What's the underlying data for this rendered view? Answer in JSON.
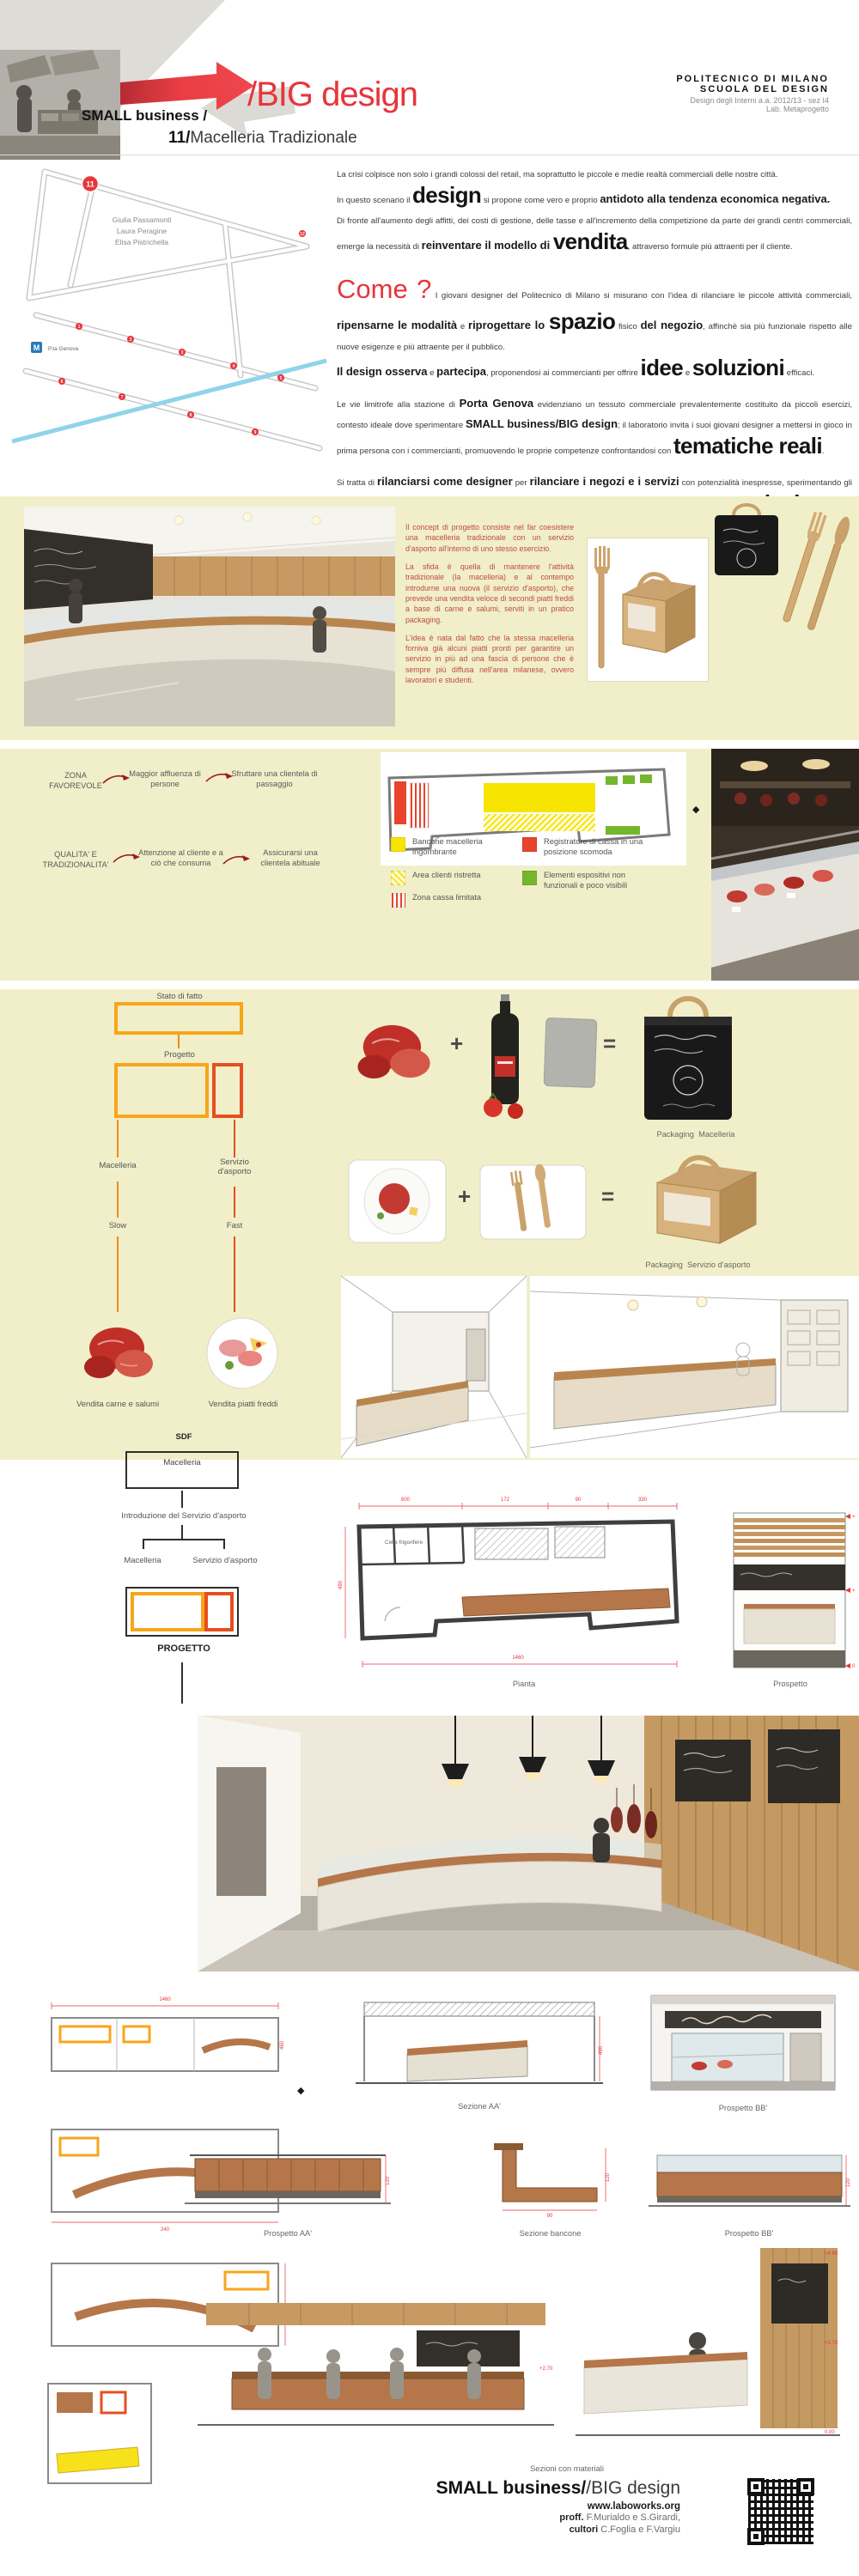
{
  "colors": {
    "accent_red": "#e8353b",
    "band_yellow": "#f1efc9",
    "orange": "#f9a51a",
    "red_orange": "#e54f20",
    "legend_yellow": "#f7e400",
    "legend_red": "#e8432c",
    "legend_green": "#74b62c",
    "concept_red": "#bf4a3c",
    "flow_arrow": "#9b1d1f"
  },
  "header": {
    "brand_small": "SMALL business /",
    "brand_big": "/BIG design",
    "project_number": "11/",
    "project_title": "Macelleria Tradizionale",
    "school_line1": "POLITECNICO DI MILANO",
    "school_line2": "SCUOLA DEL DESIGN",
    "course_line1": "Design degli Interni a.a. 2012/13 -  sez I4",
    "course_line2": "Lab. Metaprogetto"
  },
  "map": {
    "authors": [
      "Giulia Passamonti",
      "Laura Peragine",
      "Elisa Pistrichella"
    ],
    "highlight_marker": "11",
    "markers": [
      "1",
      "2",
      "3",
      "4",
      "5",
      "6",
      "7",
      "8",
      "9",
      "12"
    ],
    "metro": "M",
    "station": "P.ta Genova"
  },
  "intro": {
    "p1": [
      {
        "s": "r",
        "t": "La crisi colpisce non solo i grandi colossi del retail, ma soprattutto le piccole e medie realtà commerciali delle nostre città.\nIn questo scenario il "
      },
      {
        "s": "x",
        "t": "design"
      },
      {
        "s": "r",
        "t": " si propone come vero e proprio "
      },
      {
        "s": "b",
        "t": "antidoto alla tendenza economica negativa."
      },
      {
        "s": "r",
        "t": "\nDi fronte all'aumento degli affitti, dei costi di gestione, delle tasse e all'incremento della competizione da parte dei grandi centri commerciali, emerge la necessità di "
      },
      {
        "s": "b",
        "t": "reinventare il modello di "
      },
      {
        "s": "x",
        "t": "vendita"
      },
      {
        "s": "r",
        "t": ", attraverso formule più attraenti per il cliente."
      }
    ],
    "p2": [
      {
        "s": "c",
        "t": "Come ?"
      },
      {
        "s": "r",
        "t": " I giovani designer del Politecnico di Milano si misurano con l'idea di rilanciare le piccole attività commerciali, "
      },
      {
        "s": "b",
        "t": "ripensarne le modalità"
      },
      {
        "s": "r",
        "t": " e "
      },
      {
        "s": "b",
        "t": "riprogettare lo "
      },
      {
        "s": "x",
        "t": "spazio"
      },
      {
        "s": "r",
        "t": " fisico "
      },
      {
        "s": "b",
        "t": "del negozio"
      },
      {
        "s": "r",
        "t": ", affinchè sia più funzionale rispetto alle nuove esigenze e più attraente per il pubblico.\n"
      },
      {
        "s": "b",
        "t": "Il design osserva"
      },
      {
        "s": "r",
        "t": " e "
      },
      {
        "s": "b",
        "t": "partecipa"
      },
      {
        "s": "r",
        "t": ", proponendosi ai commercianti per offrire "
      },
      {
        "s": "x",
        "t": "idee"
      },
      {
        "s": "r",
        "t": " e "
      },
      {
        "s": "x",
        "t": "soluzioni"
      },
      {
        "s": "r",
        "t": " efficaci."
      }
    ],
    "p3": [
      {
        "s": "r",
        "t": "Le vie limitrofe alla stazione di "
      },
      {
        "s": "b",
        "t": "Porta Genova"
      },
      {
        "s": "r",
        "t": " evidenziano un tessuto commerciale prevalentemente costituito da piccoli esercizi, contesto ideale dove sperimentare "
      },
      {
        "s": "b",
        "t": "SMALL business/BIG design"
      },
      {
        "s": "r",
        "t": "; il laboratorio invita i suoi giovani designer a mettersi in gioco in prima persona con i commercianti, promuovendo le proprie competenze confrontandosi con "
      },
      {
        "s": "x",
        "t": "tematiche reali"
      },
      {
        "s": "r",
        "t": "."
      }
    ],
    "p4": [
      {
        "s": "r",
        "t": "Si tratta di "
      },
      {
        "s": "b",
        "t": "rilanciarsi come designer"
      },
      {
        "s": "r",
        "t": " per "
      },
      {
        "s": "b",
        "t": "rilanciare i negozi e i servizi"
      },
      {
        "s": "r",
        "t": " con potenzialità inespresse, sperimentando gli strumenti del progetto di interni; "
      },
      {
        "s": "b",
        "t": "promuovere le piccole realtà di vendita"
      },
      {
        "s": "r",
        "t": " che caratterizzano la "
      },
      {
        "s": "x",
        "t": "ricchezza"
      },
      {
        "s": "r",
        "t": " non solo commerciale ma anche sociale "
      },
      {
        "s": "b",
        "t": "di un quartiere."
      }
    ]
  },
  "concept": {
    "p1": "Il concept di progetto consiste nel far coesistere una macelleria tradizionale con un servizio d'asporto all'interno di uno stesso esercizio.",
    "p2": "La sfida è quella di mantenere l'attività tradizionale (la macelleria) e al contempo introdurne una nuova (il servizio d'asporto), che prevede una vendita veloce di secondi piatti freddi a base di carne e salumi, serviti in un pratico packaging.",
    "p3": "L'idea è nata dal fatto che la stessa macelleria forniva già alcuni piatti pronti per garantire un servizio in più ad una fascia di persone che è sempre più diffusa nell'area milanese, ovvero lavoratori e studenti."
  },
  "analysis": {
    "flow1": {
      "a": "ZONA FAVOREVOLE",
      "b": "Maggior affluenza di persone",
      "c": "Sfruttare una clientela di passaggio"
    },
    "flow2": {
      "a": "QUALITA' E TRADIZIONALITA'",
      "b": "Attenzione al cliente e a ciò che consuma",
      "c": "Assicurarsi una clientela abituale"
    },
    "legend": [
      {
        "label": "Bancone macelleria ingombrante"
      },
      {
        "label": "Registratore di cassa in una posizione scomoda"
      },
      {
        "label": "Area clienti ristretta"
      },
      {
        "label": "Zona cassa limitata"
      },
      {
        "label": "Elementi espositivi non funzionali e poco visibili"
      }
    ]
  },
  "strategy": {
    "state": "Stato di fatto",
    "project": "Progetto",
    "macelleria": "Macelleria",
    "servizio": "Servizio d'asporto",
    "slow": "Slow",
    "fast": "Fast",
    "caption_meat": "Vendita carne e salumi",
    "caption_plates": "Vendita piatti freddi",
    "plus": "+",
    "equals": "=",
    "packaging": "Packaging",
    "pack1": "Macelleria",
    "pack2": "Servizio d'asporto"
  },
  "process": {
    "sdf": "SDF",
    "box": "Macelleria",
    "step": "Introduzione del Servizio d'asporto",
    "left": "Macelleria",
    "right": "Servizio d'asporto",
    "project": "PROGETTO"
  },
  "drawings": {
    "pianta": "Pianta",
    "prospetto": "Prospetto",
    "celle": "Celle frigorifere",
    "sezione_aa": "Sezione AA'",
    "prospetto_bb": "Prospetto BB'",
    "prospetto_aa": "Prospetto AA'",
    "sezione_bancone": "Sezione bancone",
    "prospetto_bb2": "Prospetto BB'",
    "sezioni_materiali": "Sezioni con materiali",
    "dims": {
      "d600": "600",
      "d172": "172",
      "d90": "90",
      "d330": "330",
      "d1460": "1460",
      "d490": "490",
      "d460": "460",
      "d240": "240",
      "d150": "150",
      "d120": "120",
      "lv1": "+4.90",
      "lv2": "+2.20",
      "lv3": "0.00",
      "lv4": "+2.70"
    }
  },
  "glyphs": {
    "diamond": "◆"
  },
  "footer": {
    "brand_bold": "SMALL business/",
    "brand_light": "/BIG design",
    "site": "www.laboworks.org",
    "cred1b": "proff.",
    "cred1": " F.Murialdo e S.Girardi,",
    "cred2b": "cultori",
    "cred2": " C.Foglia e F.Vargiu"
  }
}
